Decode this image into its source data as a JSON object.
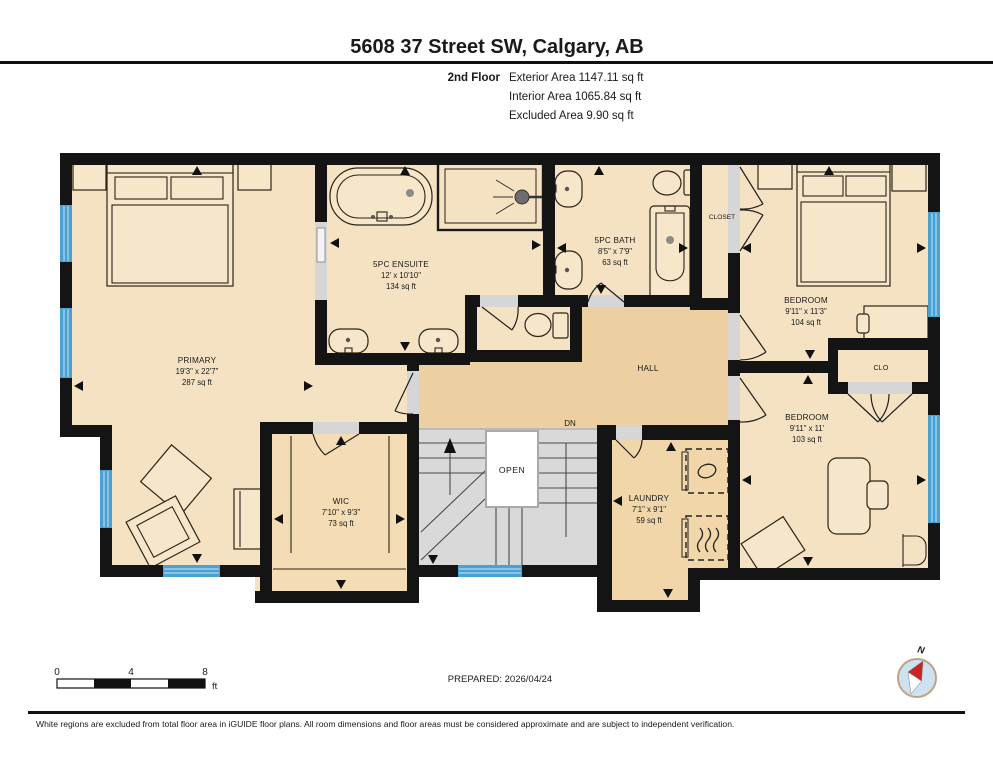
{
  "header": {
    "title": "5608 37 Street SW, Calgary, AB",
    "floor_label": "2nd Floor",
    "exterior_area": "Exterior Area 1147.11 sq ft",
    "interior_area": "Interior Area 1065.84 sq ft",
    "excluded_area": "Excluded Area 9.90 sq ft"
  },
  "rooms": {
    "primary": {
      "name": "PRIMARY",
      "dims": "19'3\" x 22'7\"",
      "area": "287 sq ft"
    },
    "ensuite": {
      "name": "5PC ENSUITE",
      "dims": "12' x 10'10\"",
      "area": "134 sq ft"
    },
    "bath": {
      "name": "5PC BATH",
      "dims": "8'5\" x 7'9\"",
      "area": "63 sq ft"
    },
    "closet": {
      "name": "CLOSET"
    },
    "bedroom1": {
      "name": "BEDROOM",
      "dims": "9'11\" x 11'3\"",
      "area": "104 sq ft"
    },
    "clo": {
      "name": "CLO"
    },
    "bedroom2": {
      "name": "BEDROOM",
      "dims": "9'11\" x 11'",
      "area": "103 sq ft"
    },
    "wic": {
      "name": "WIC",
      "dims": "7'10\" x 9'3\"",
      "area": "73 sq ft"
    },
    "laundry": {
      "name": "LAUNDRY",
      "dims": "7'1\" x 9'1\"",
      "area": "59 sq ft"
    },
    "hall": {
      "name": "HALL"
    },
    "stairs": {
      "open_label": "OPEN",
      "down_label": "DN"
    }
  },
  "scale_bar": {
    "start": "0",
    "mid": "4",
    "end": "8",
    "unit": "ft"
  },
  "compass": {
    "north_label": "N"
  },
  "footer": {
    "prepared": "PREPARED: 2026/04/24",
    "disclaimer": "White regions are excluded from total floor area in iGUIDE floor plans. All room dimensions and floor areas must be considered approximate and are subject to independent verification."
  },
  "colors": {
    "wall": "#141414",
    "room_fill": "#f5e2c3",
    "hall_fill": "#ecd0a2",
    "wic_fill": "#f4dcb4",
    "laundry_fill": "#f1d6a9",
    "stairs_fill": "#d9d9d9",
    "window_blue": "#4aa2d4",
    "compass_red": "#cc2222"
  }
}
